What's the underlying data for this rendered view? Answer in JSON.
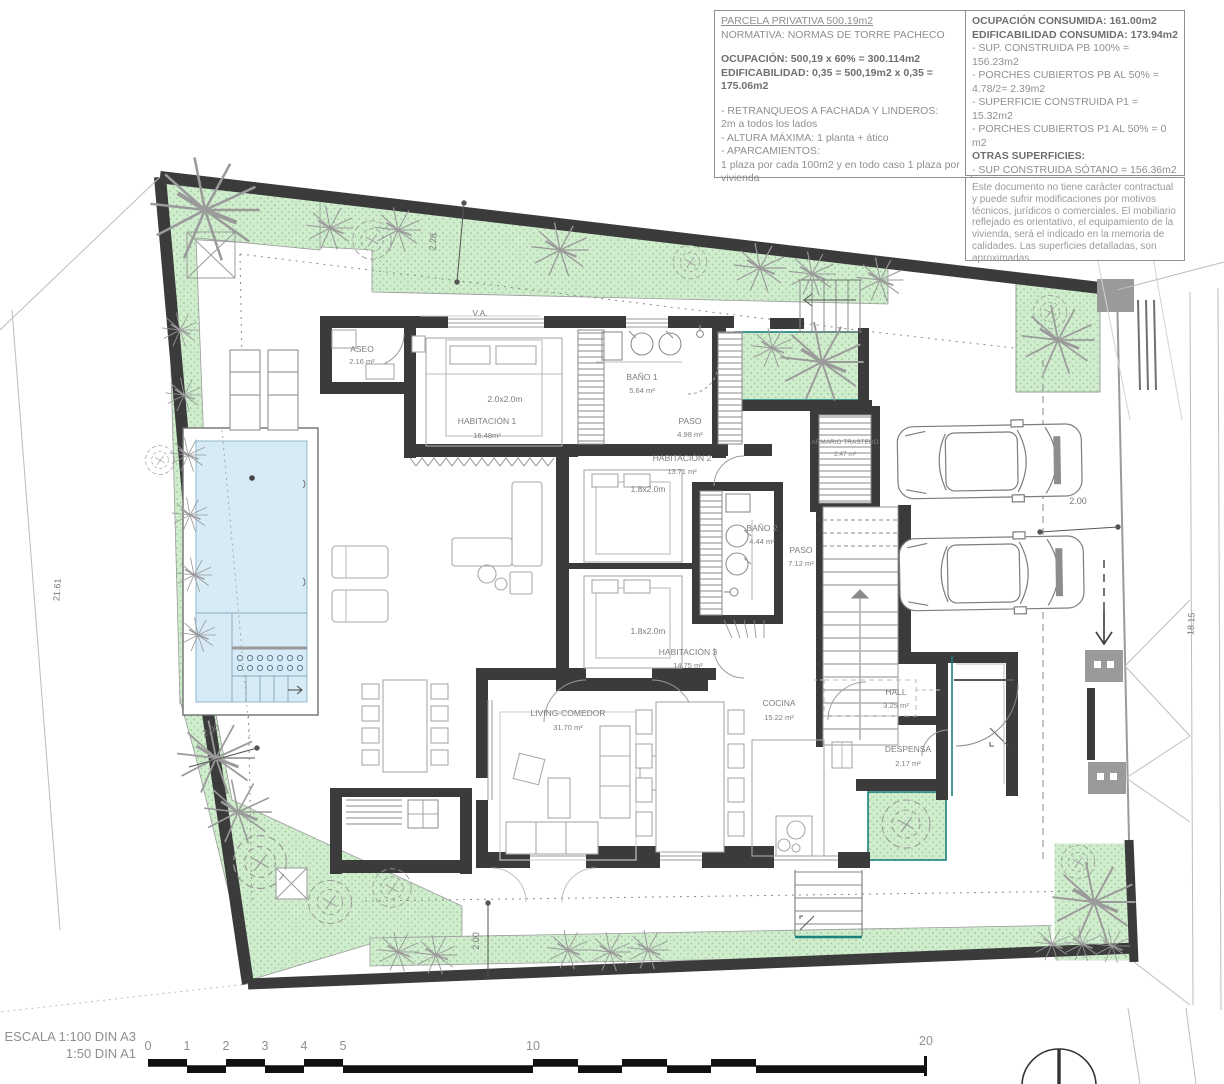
{
  "panel_parcela": {
    "title": "PARCELA  PRIVATIVA 500.19m2",
    "normativa": "NORMATIVA: NORMAS DE TORRE PACHECO",
    "ocupacion": "OCUPACIÓN: 500,19 x 60% = 300.114m2",
    "edificabilidad": "EDIFICABILIDAD: 0,35 = 500,19m2 x 0,35 = 175.06m2",
    "retranqueos_label": "- RETRANQUEOS A FACHADA Y LINDEROS:",
    "retranqueos_value": "2m a todos los lados",
    "altura": "- ALTURA MÁXIMA: 1 planta + ático",
    "aparcamientos_label": "- APARCAMIENTOS:",
    "aparcamientos_value": "1 plaza por cada 100m2 y en todo caso 1 plaza por vivienda"
  },
  "panel_consumos": {
    "ocupacion": "OCUPACIÓN CONSUMIDA: 161.00m2",
    "edificabilidad": "EDIFICABILIDAD CONSUMIDA: 173.94m2",
    "sup_pb": "- SUP. CONSTRUIDA PB 100%  = 156.23m2",
    "porches_pb1": "- PORCHES CUBIERTOS PB AL 50% =",
    "porches_pb2": "4.78/2= 2.39m2",
    "sup_p1": "- SUPERFICIE CONSTRUIDA P1 =  15.32m2",
    "porches_p1": "- PORCHES CUBIERTOS P1 AL 50%  =    0  m2",
    "otras": "OTRAS SUPERFICIES:",
    "sotano": "- SUP CONSTRUIDA SÓTANO =   156.36m2",
    "patios": "- SUP ÚTIL PATIOS =  9.18m2"
  },
  "disclaimer": "Este documento no tiene carácter contractual y puede sufrir modificaciones por motivos técnicos, jurídicos o comerciales. El mobiliario reflejado es orientativo, el equipamiento de la  vivienda, será el indicado en la memoria de calidades. Las superficies detalladas, son aproximadas.",
  "rooms": [
    {
      "name": "ASEO",
      "area": "2.16 m²"
    },
    {
      "name": "HABITACIÓN 1",
      "area": "16.48m²"
    },
    {
      "name": "BAÑO 1",
      "area": "5.64 m²"
    },
    {
      "name": "PASO",
      "area": "4.98 m²"
    },
    {
      "name": "HABITACIÓN 2",
      "area": "13.71 m²"
    },
    {
      "name": "BAÑO 2",
      "area": "4.44 m²"
    },
    {
      "name": "PASO",
      "area": "7.12 m²"
    },
    {
      "name": "ARMARIO TRASTERO",
      "area": "2.47 m²"
    },
    {
      "name": "HABITACIÓN 3",
      "area": "14.75 m²"
    },
    {
      "name": "LIVING-COMEDOR",
      "area": "31.70 m²"
    },
    {
      "name": "COCINA",
      "area": "15.22 m²"
    },
    {
      "name": "HALL",
      "area": "3.25 m²"
    },
    {
      "name": "DESPENSA",
      "area": "2.17 m²"
    }
  ],
  "beds": [
    "2.0x2.0m",
    "1.8x2.0m",
    "1.8x2.0m"
  ],
  "labels": {
    "va": "V.A."
  },
  "dimensions": {
    "left": "21.61",
    "right": "18.15",
    "top": "2.28",
    "garage": "2.00",
    "garden": "2.00",
    "bottom": "2.00"
  },
  "scale": {
    "line1": "ESCALA 1:100 DIN A3",
    "line2": "1:50 DIN A1",
    "ticks": [
      "0",
      "1",
      "2",
      "3",
      "4",
      "5",
      "10",
      "20"
    ]
  },
  "colors": {
    "wall": "#3b3b3b",
    "green": "#cfeccd",
    "pool": "#d6ebf6",
    "teal": "#1b7f7e",
    "gray_box": "#9a9a9a"
  }
}
